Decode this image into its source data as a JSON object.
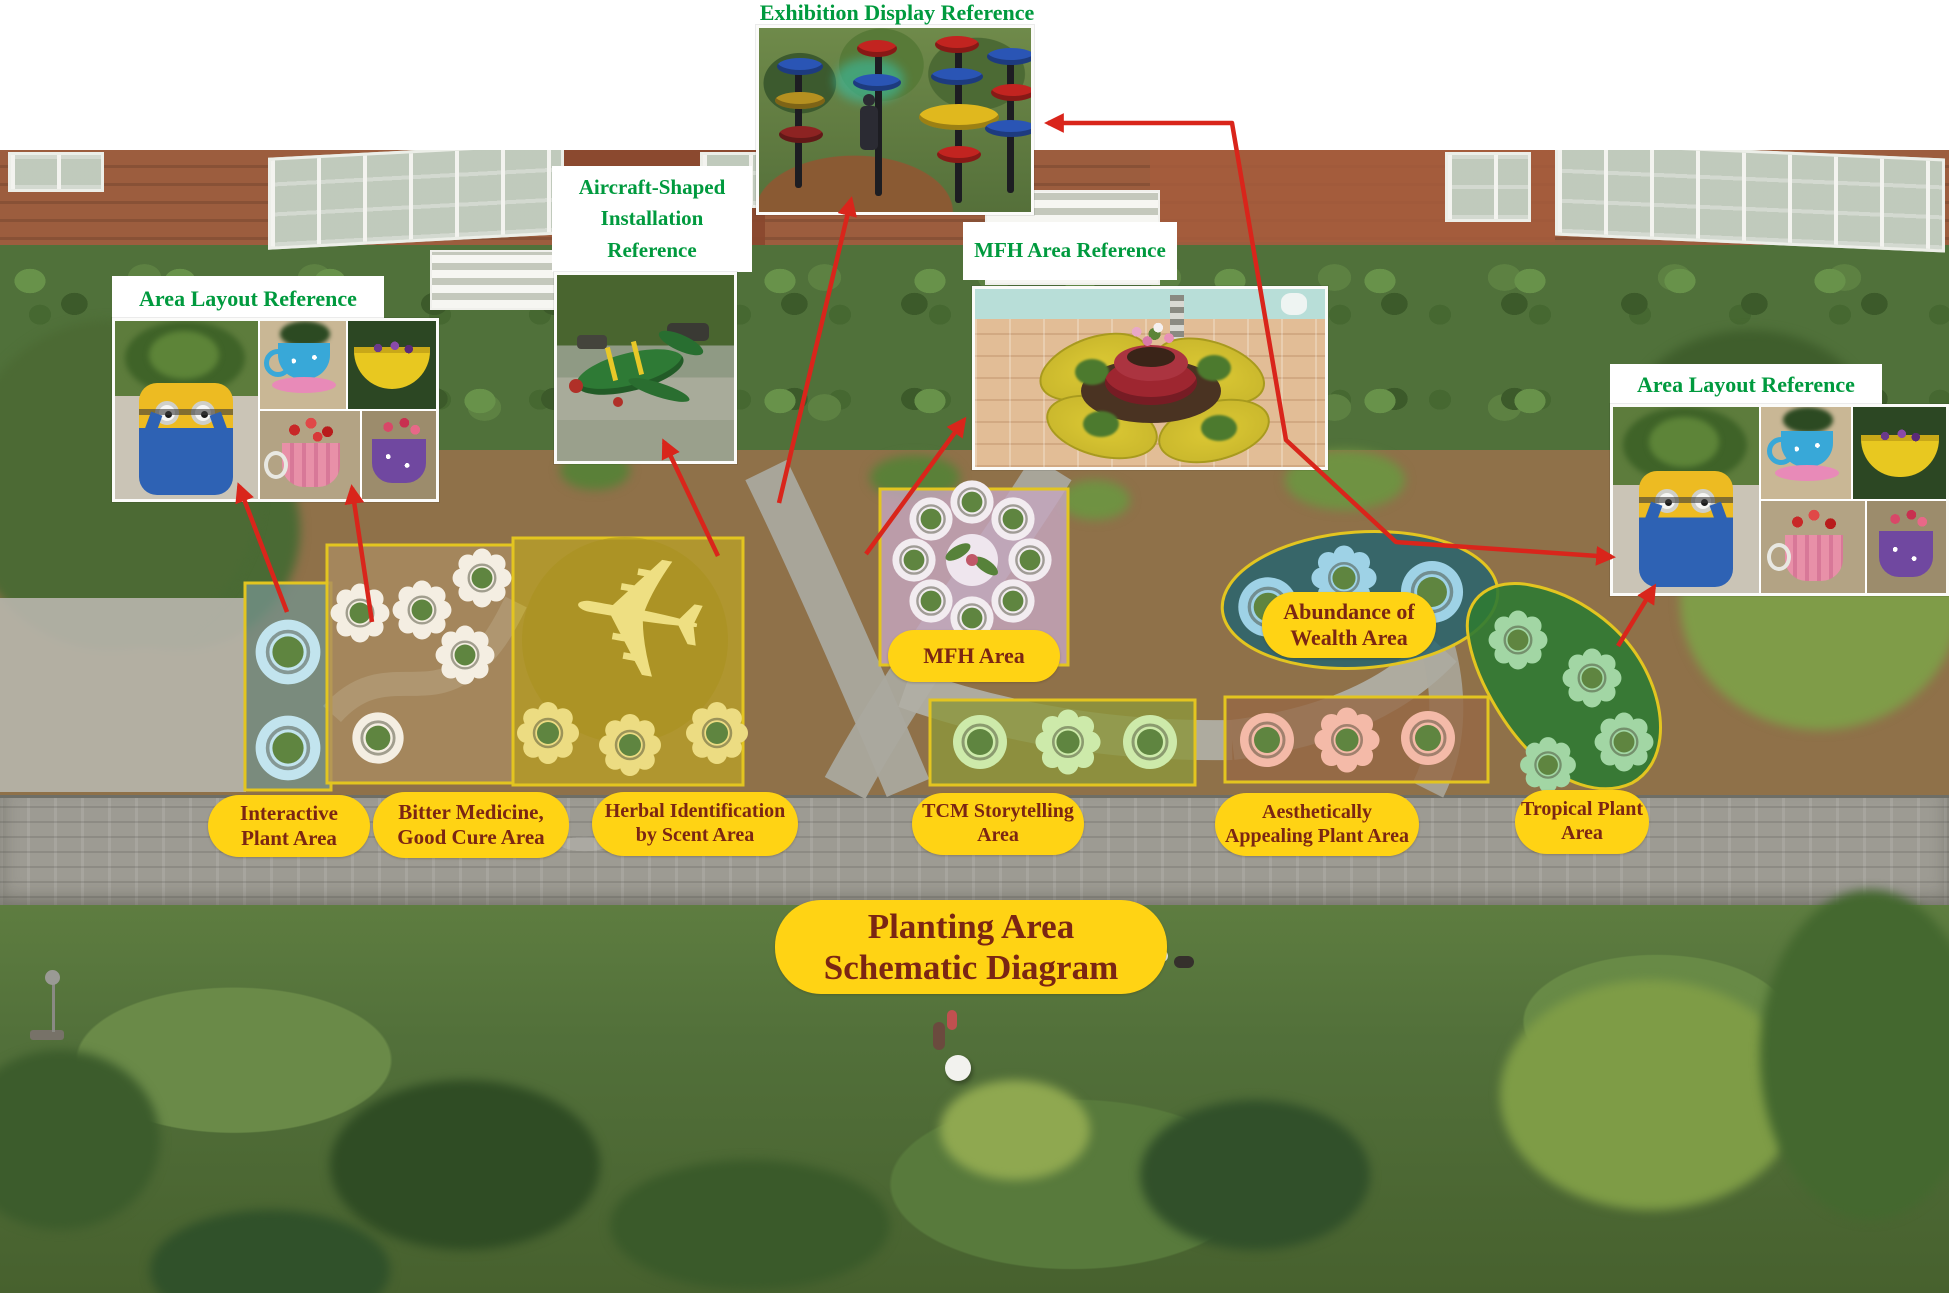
{
  "title_pill": {
    "lines": [
      "Planting Area",
      "Schematic Diagram"
    ]
  },
  "references": {
    "exhibition": {
      "label": "Exhibition Display Reference"
    },
    "aircraft": {
      "lines": [
        "Aircraft-Shaped",
        "Installation",
        "Reference"
      ]
    },
    "mfh": {
      "label": "MFH Area Reference"
    },
    "area_layout_left": {
      "label": "Area Layout Reference"
    },
    "area_layout_right": {
      "label": "Area Layout Reference"
    }
  },
  "plan_labels": {
    "mfh_area": {
      "lines": [
        "MFH Area"
      ]
    },
    "abundance": {
      "lines": [
        "Abundance of",
        "Wealth Area"
      ]
    }
  },
  "area_pills": [
    {
      "id": "interactive",
      "lines": [
        "Interactive",
        "Plant Area"
      ]
    },
    {
      "id": "bitter",
      "lines": [
        "Bitter Medicine,",
        "Good Cure Area"
      ]
    },
    {
      "id": "herbal",
      "lines": [
        "Herbal Identification",
        "by Scent Area"
      ]
    },
    {
      "id": "tcm",
      "lines": [
        "TCM Storytelling",
        "Area"
      ]
    },
    {
      "id": "aesthetic",
      "lines": [
        "Aesthetically",
        "Appealing Plant Area"
      ]
    },
    {
      "id": "tropical",
      "lines": [
        "Tropical Plant",
        "Area"
      ]
    }
  ],
  "icons": {
    "plane_glyph": "✈"
  },
  "colors": {
    "reference_title_green": "#009a3e",
    "pill_yellow": "#ffd314",
    "pill_text_maroon": "#7b2613",
    "arrow_red": "#d9251b",
    "area_border_yellow": "#e3c520"
  }
}
